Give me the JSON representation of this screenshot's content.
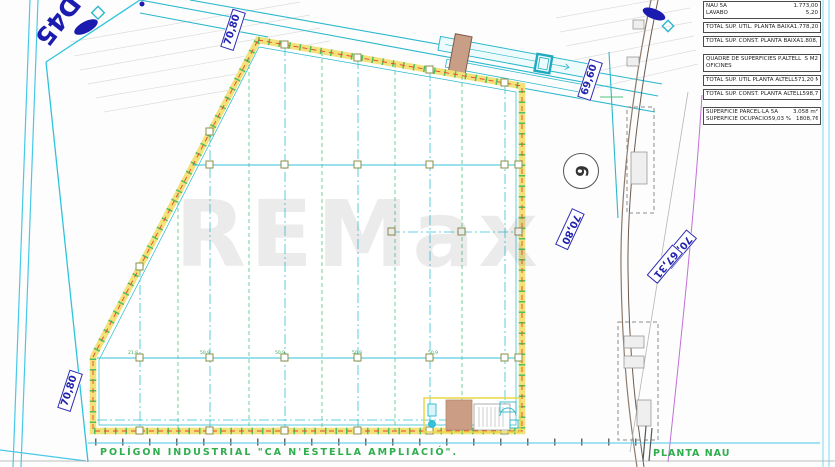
{
  "page": {
    "project_title": "POLÍGON  INDUSTRIAL  \"CA N'ESTELLA  AMPLIACIÓ\".",
    "drawing_title": "PLANTA NAU",
    "watermark": "REMax",
    "street_label": "D45",
    "parcel_marker": "6"
  },
  "colors": {
    "line_cyan": "#3cc5dc",
    "line_teal": "#1fa9bd",
    "grid_green": "#4ec57f",
    "wall_yellow": "#f0e27a",
    "wall_red": "#e8452c",
    "label_blue": "#2323ae",
    "title_green": "#2fae4e",
    "road_brown": "#8d7a6b",
    "fill_tan": "#c99e87",
    "magenta": "#c36fd9"
  },
  "tables": {
    "baixa": {
      "rows": [
        {
          "label": "NAU 5A",
          "value": "1.773,00"
        },
        {
          "label": "LAVABO",
          "value": "5,20"
        }
      ],
      "total_util_label": "TOTAL SUP. ÚTIL. PLANTA BAIXA",
      "total_util_value": "1.778,20 m²",
      "total_const_label": "TOTAL SUP. CONST. PLANTA BAIXA",
      "total_const_value": "1.808,76 m²"
    },
    "altell": {
      "header_label": "QUADRE DE SUPERFICIES  P.ALTELL",
      "header_value": "S  M2",
      "sub_label": "OFICINES",
      "total_util_label": "TOTAL SUP. ÚTIL PLANTA ALTELL",
      "total_util_value": "571,20 M²",
      "total_const_label": "TOTAL SUP. CONST. PLANTA ALTELL",
      "total_const_value": "598,74 M²"
    },
    "parcella": {
      "rows": [
        {
          "label": "SUPERFÍCIE PARCEL·LA 5A",
          "pct": "",
          "value": "3.058 m²"
        },
        {
          "label": "SUPERFÍCIE OCUPACIÓ",
          "pct": "59,03 %",
          "value": "1808,76 m²"
        }
      ]
    }
  },
  "dimensions": {
    "boundary_labels": [
      {
        "text": "70,80",
        "x": 233,
        "y": 30,
        "rot": -72
      },
      {
        "text": "70,80",
        "x": 70,
        "y": 391,
        "rot": -72
      },
      {
        "text": "69,60",
        "x": 590,
        "y": 80,
        "rot": -72
      },
      {
        "text": "70,80",
        "x": 570,
        "y": 229,
        "rot": 115
      },
      {
        "text": "70,64",
        "x": 679,
        "y": 249,
        "rot": 130
      },
      {
        "text": "67,31",
        "x": 665,
        "y": 264,
        "rot": 130
      }
    ],
    "interior_labels": [
      {
        "text": "21,8",
        "x": 128,
        "y": 351
      },
      {
        "text": "50,9",
        "x": 200,
        "y": 351
      },
      {
        "text": "50,9",
        "x": 275,
        "y": 351
      },
      {
        "text": "50,9",
        "x": 352,
        "y": 351
      },
      {
        "text": "50,9",
        "x": 428,
        "y": 351
      }
    ]
  }
}
